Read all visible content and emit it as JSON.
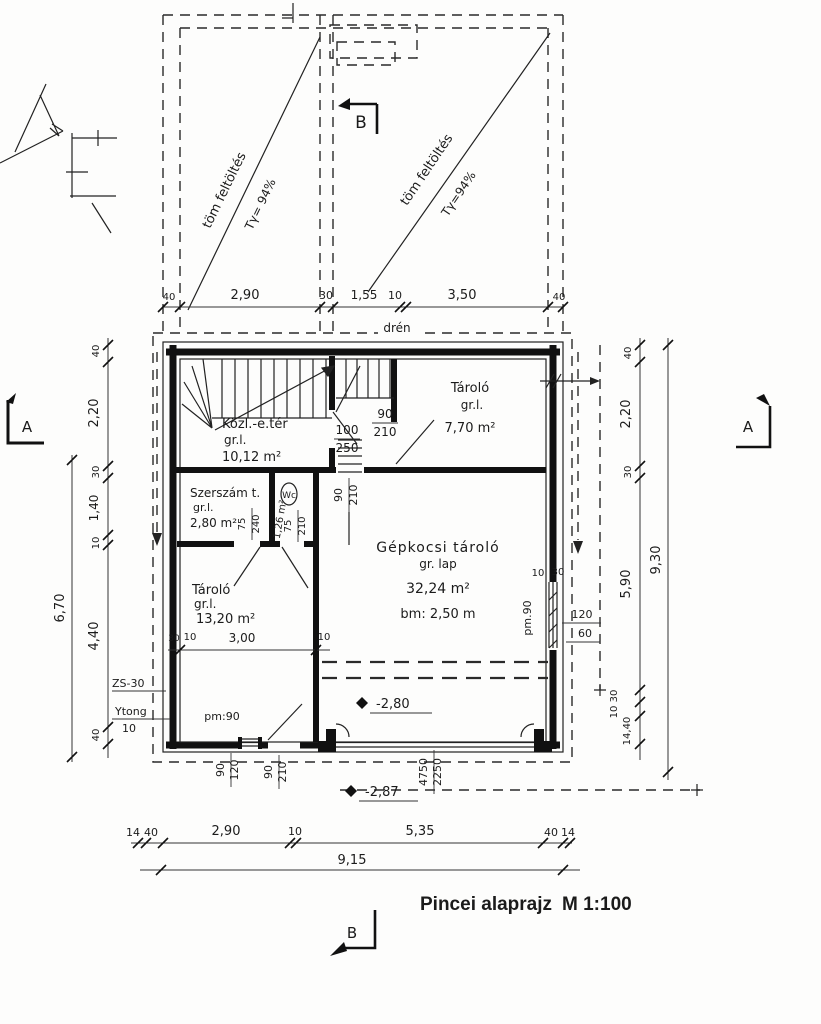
{
  "title": {
    "name": "Pincei alaprajz",
    "scale": "M 1:100"
  },
  "section_markers": {
    "a_left": "A",
    "a_right": "A",
    "b_top": "B",
    "b_bottom": "B"
  },
  "backfill": {
    "left": {
      "label": "töm feltöltés",
      "compaction": "Tγ= 94%"
    },
    "right": {
      "label": "töm feltöltés",
      "compaction": "Tγ=94%"
    }
  },
  "notes": {
    "drain": "drén",
    "wall_type": "ZS-30",
    "block_type": "Ytong",
    "block_size": "10",
    "parapet_bottom": "pm:90",
    "parapet_right": "pm.90"
  },
  "rooms": {
    "hall": {
      "name": "Közl.-e.tér",
      "floor": "gr.l.",
      "area": "10,12 m²"
    },
    "storage_top": {
      "name": "Tároló",
      "floor": "gr.l.",
      "area": "7,70 m²"
    },
    "tools": {
      "name": "Szerszám t.",
      "floor": "gr.l.",
      "area": "2,80 m²"
    },
    "wc": {
      "name": "Wc",
      "area": "1,26 m²"
    },
    "storage_left": {
      "name": "Tároló",
      "floor": "gr.l.",
      "area": "13,20 m²"
    },
    "garage": {
      "name": "Gépkocsi tároló",
      "floor": "gr. lap",
      "area": "32,24 m²",
      "height": "bm: 2,50 m"
    }
  },
  "openings": {
    "stair_door": {
      "w": "100",
      "h": "250"
    },
    "storage_top_door": {
      "w": "90",
      "h": "210"
    },
    "garage_top_door": {
      "w": "90",
      "h": "210"
    },
    "tools_door": {
      "w": "75",
      "h": "240"
    },
    "wc_door": {
      "w": "75",
      "h": "210"
    },
    "right_window": {
      "w": "120",
      "h": "60",
      "t1": "10",
      "t2": "30"
    },
    "bottom_window": {
      "w": "90",
      "h": "120"
    },
    "bottom_door": {
      "w": "90",
      "h": "210"
    },
    "garage_gate": {
      "w": "4750",
      "h": "2250"
    }
  },
  "levels": {
    "garage": "-2,80",
    "outside": "-2,87"
  },
  "dims": {
    "top": [
      "40",
      "2,90",
      "30",
      "1,55",
      "10",
      "3,50",
      "40"
    ],
    "bottom": [
      "14",
      "40",
      "2,90",
      "10",
      "5,35",
      "40",
      "14"
    ],
    "bottom_total": "9,15",
    "left": [
      "40",
      "2,20",
      "30",
      "1,40",
      "10",
      "4,40",
      "40"
    ],
    "left_total": "6,70",
    "right": [
      "40",
      "2,20",
      "30",
      "5,90",
      "30",
      "10",
      "14,40"
    ],
    "right_total": "9,30",
    "storage_inner": [
      "30",
      "10",
      "3,00",
      "10"
    ]
  }
}
